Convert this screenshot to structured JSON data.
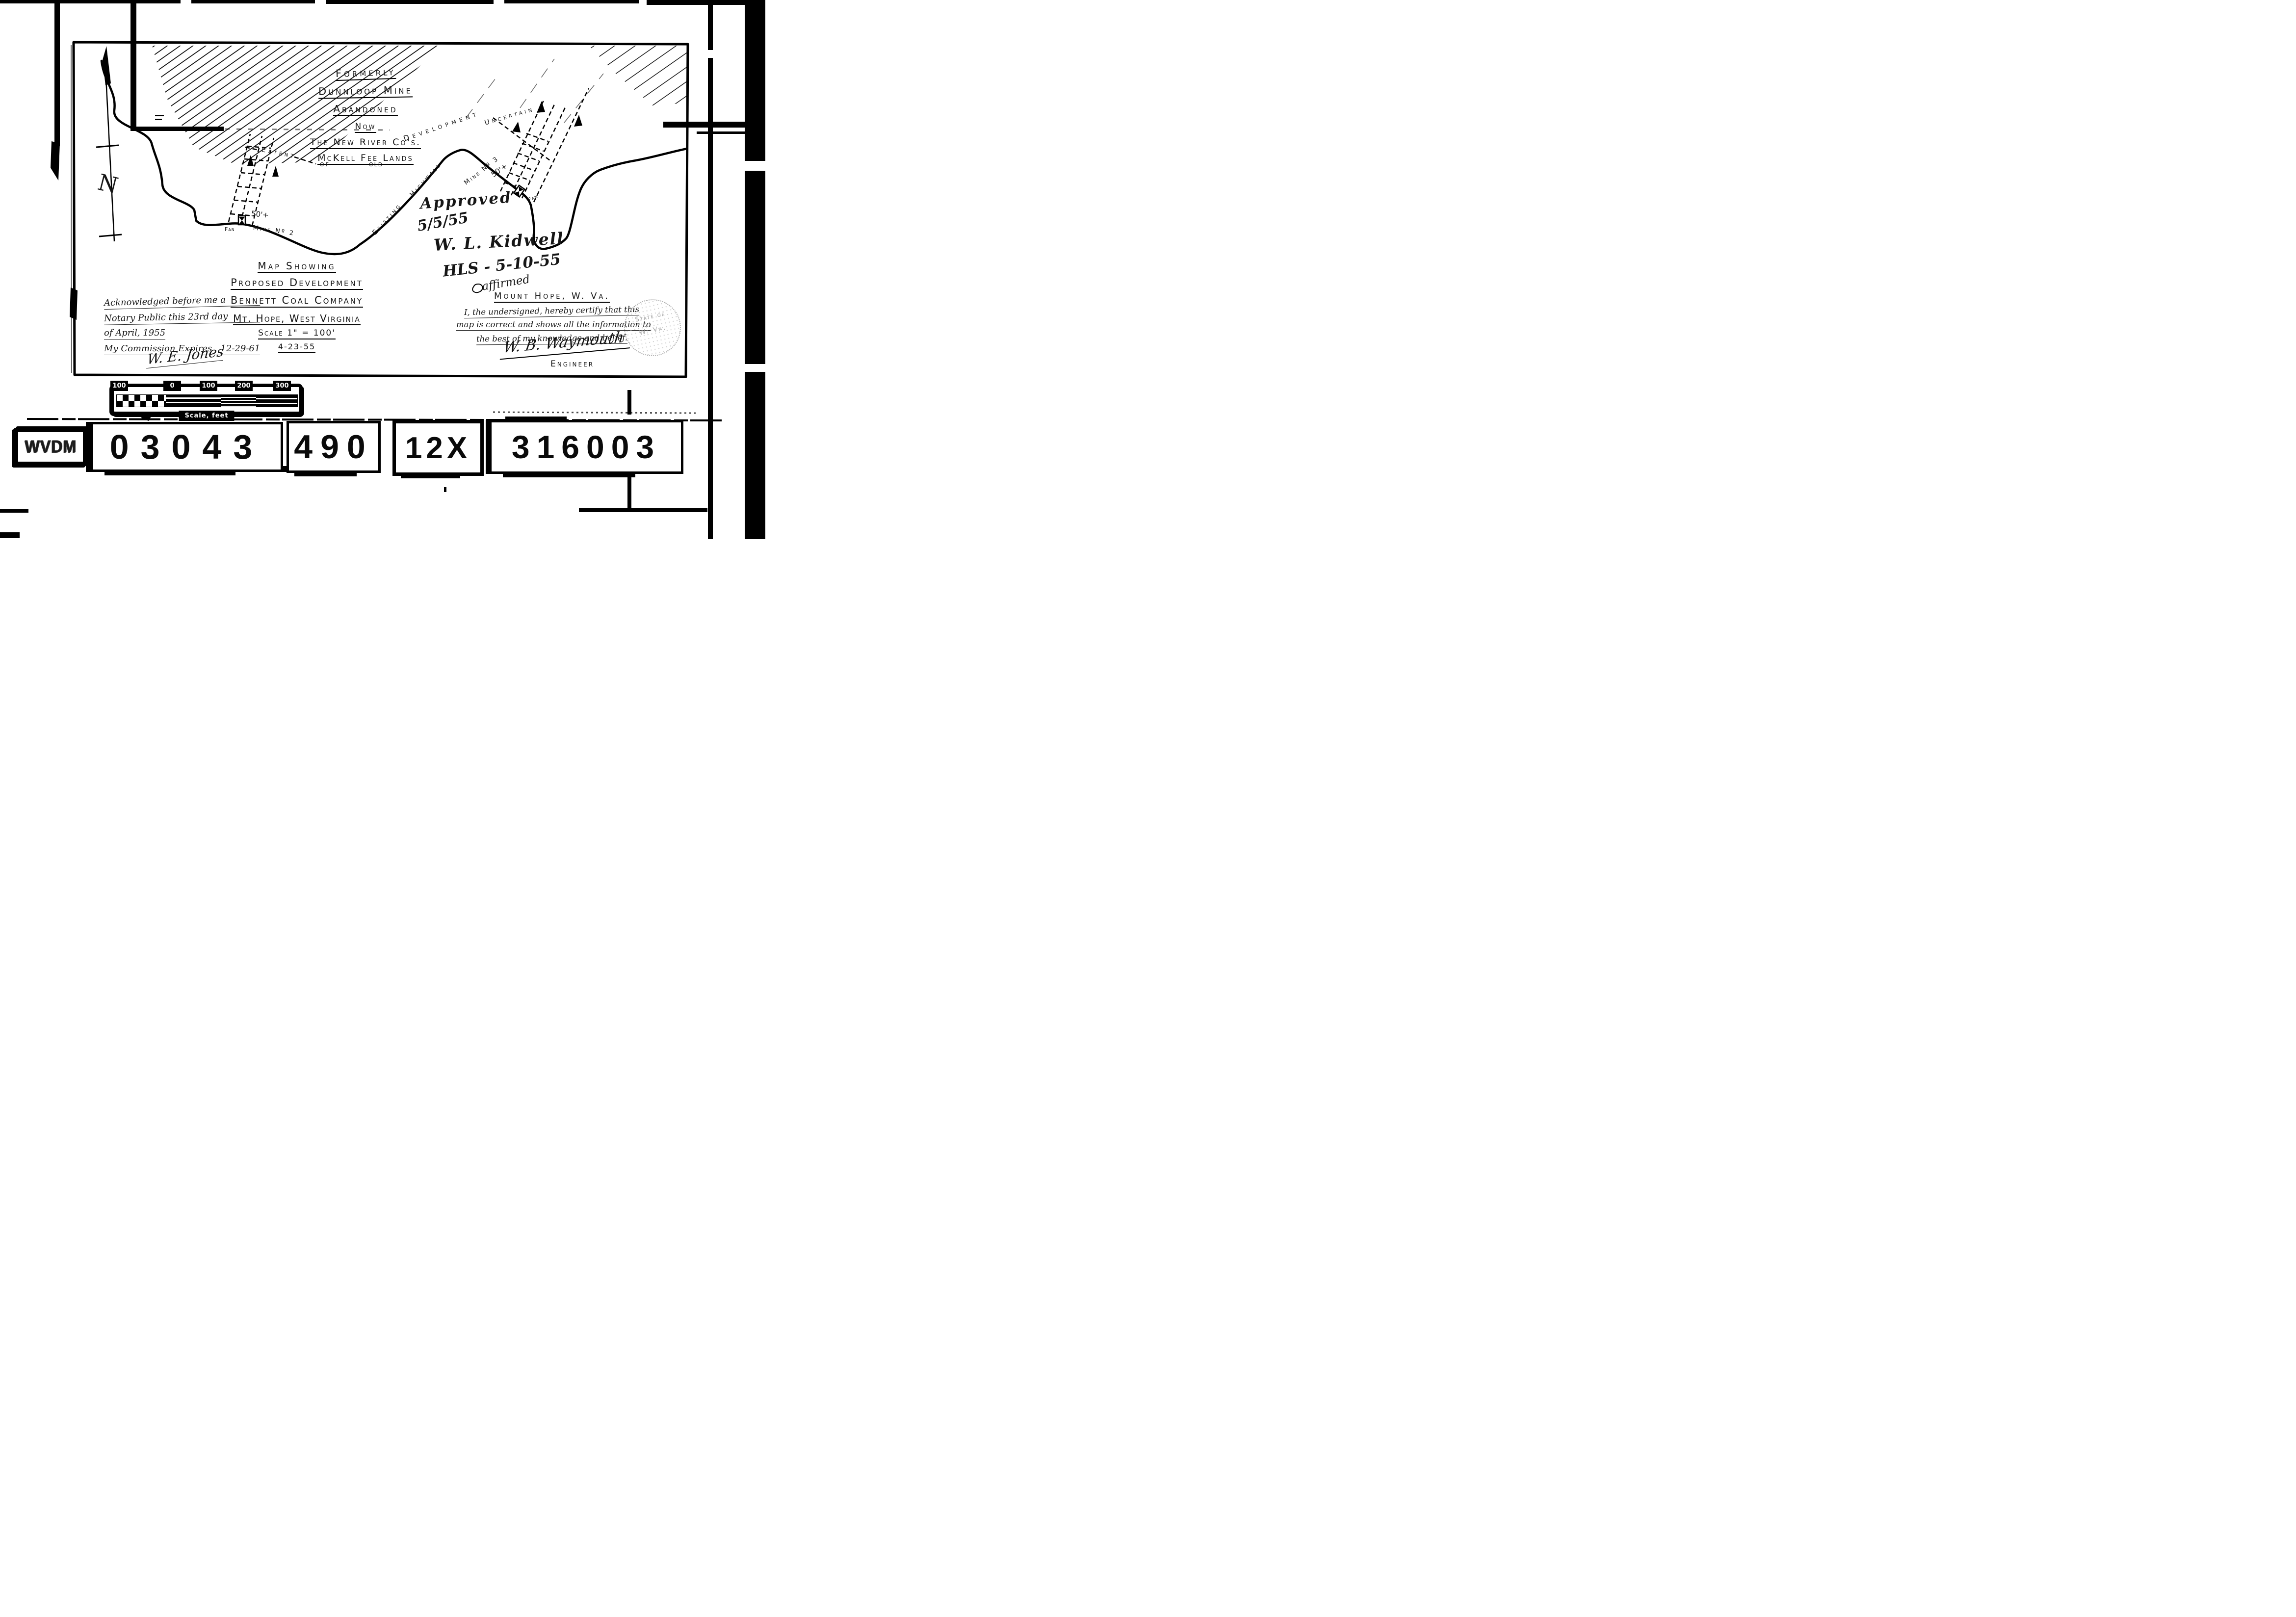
{
  "badge": {
    "label": "WVDM"
  },
  "id_cards": {
    "c1": "03043",
    "c2": "490",
    "c3": "12X",
    "c4": "316003"
  },
  "map": {
    "north": "N",
    "legend": {
      "formerly": "Formerly",
      "dunnloop": "Dunnloop Mine",
      "abandoned": "Abandoned",
      "now": "Now",
      "new_river": "The New River Co's.",
      "mckell": "McKell Fee Lands",
      "of": "of",
      "old": "old"
    },
    "labels": {
      "existing": "Existing",
      "highwall": "Highwall",
      "development": "Development",
      "uncertain": "Uncertain",
      "extent": "Extent",
      "fifty_plus_2": "50'+",
      "mine2": "Mine Nº 2",
      "fan2": "Fan",
      "fifty_plus_3": "50'+",
      "mine3": "Mine Nº 3",
      "fan3": "Fan"
    },
    "title_block": {
      "l1": "Map Showing",
      "l2": "Proposed Development",
      "l3": "Bennett Coal Company",
      "l4": "Mt. Hope, West Virginia",
      "l5": "Scale 1\" = 100'",
      "l6": "4-23-55"
    },
    "notary": {
      "l1": "Acknowledged before me a",
      "l2": "Notary Public this 23rd day",
      "l3": "of April, 1955",
      "l4": "My Commission Expires   12-29-61",
      "signature": "W. E. Jones"
    },
    "approval": {
      "l1": "Approved",
      "l2": "5/5/55",
      "l3": "W. L. Kidwell",
      "l4": "HLS - 5-10-55",
      "l5": "affirmed"
    },
    "certification": {
      "place": "Mount Hope, W. Va.",
      "l1": "I, the undersigned, hereby certify that this",
      "l2": "map is correct and shows all the information to",
      "l3": "the best of my knowledge and belief.",
      "signature": "W. B. Waymouth",
      "title": "Engineer"
    },
    "seal": {
      "t1": "State of",
      "t2": "W. Va."
    }
  },
  "scalebar": {
    "ticks": {
      "t1": "100",
      "t2": "0",
      "t3": "100",
      "t4": "200",
      "t5": "300"
    },
    "caption": "Scale, feet"
  }
}
